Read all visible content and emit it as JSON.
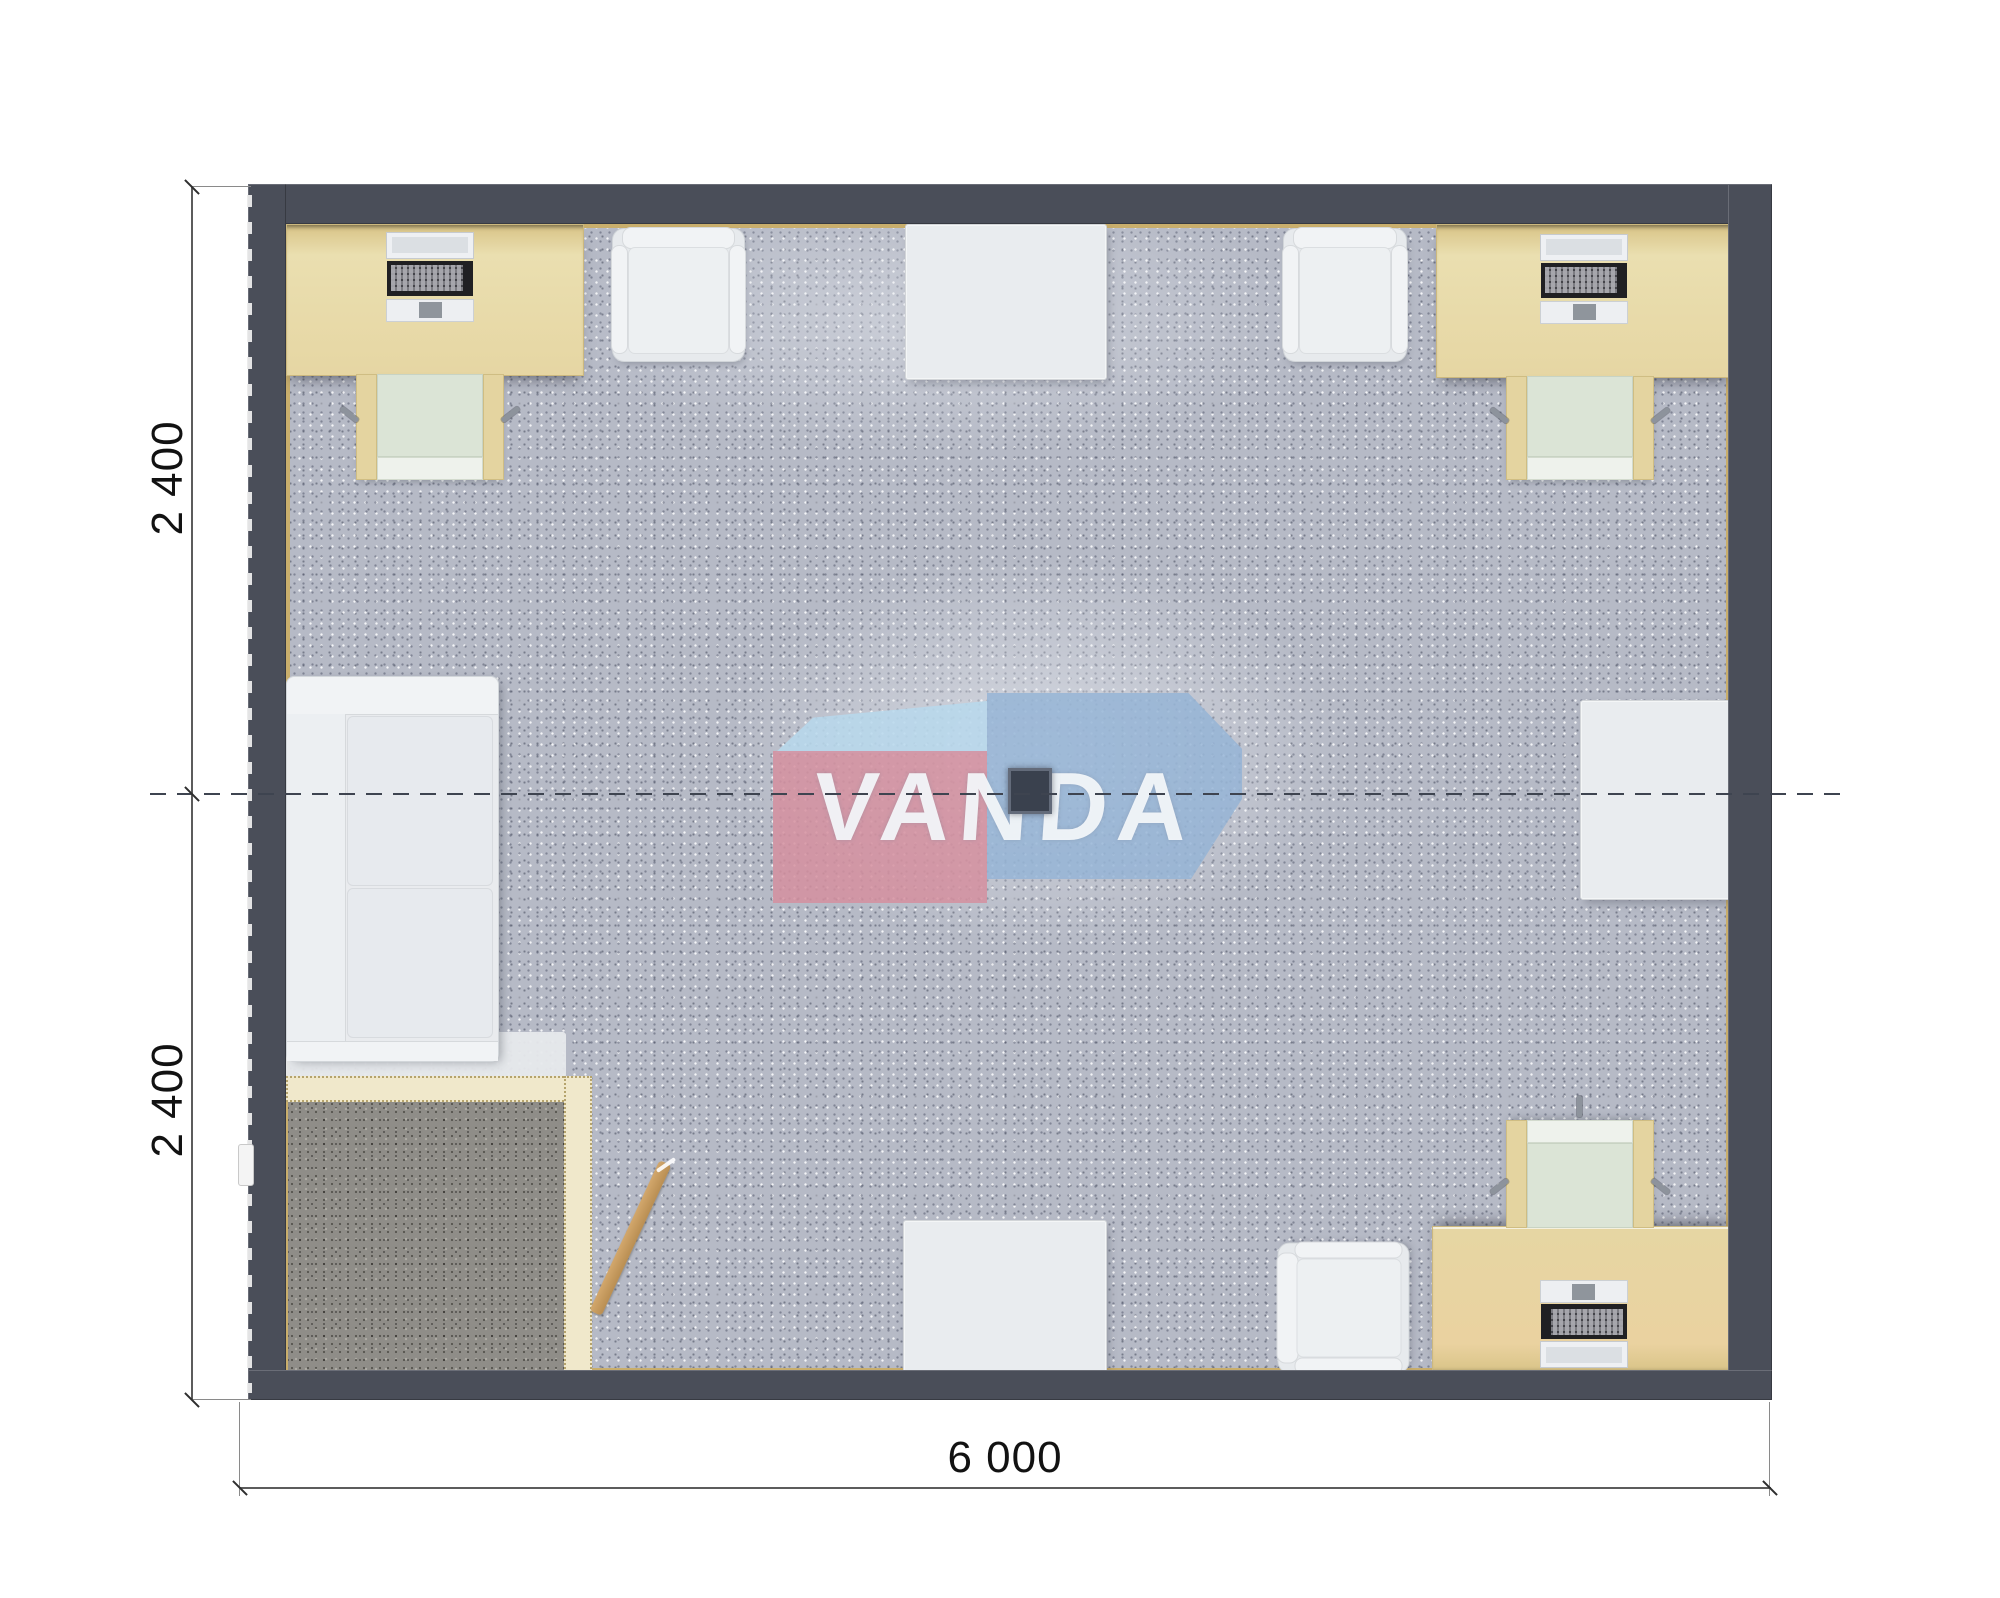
{
  "plan": {
    "watermark_text": "VANDA",
    "dim_left_top": "2 400",
    "dim_left_bottom": "2 400",
    "dim_bottom": "6 000",
    "colors": {
      "wall": "#4a4e59",
      "floor_base": "#b6bac6",
      "floor_edge_trim": "#c9ae6c",
      "desk_wood": "#e6d6a3",
      "chair_seat": "#dbe4d6",
      "partition_cream": "#f0e8cb",
      "entry_mat": "#8f8d88",
      "furniture_white": "#e9ebee",
      "door_stick_wood": "#c49a5d",
      "watermark_pink": "#d58f9f",
      "watermark_blue": "#94b3d5",
      "watermark_blue_light": "#b7d8ec",
      "dimension_line": "#5c5c5c",
      "section_dash": "#3e4450"
    },
    "furniture_counts": {
      "desk_with_computer": 3,
      "desk_chair": 3,
      "lounge_armchair": 3,
      "white_table": 3,
      "sofa": 1,
      "entry_vestibule_mat": 1,
      "ceiling_lamp": 1
    }
  }
}
